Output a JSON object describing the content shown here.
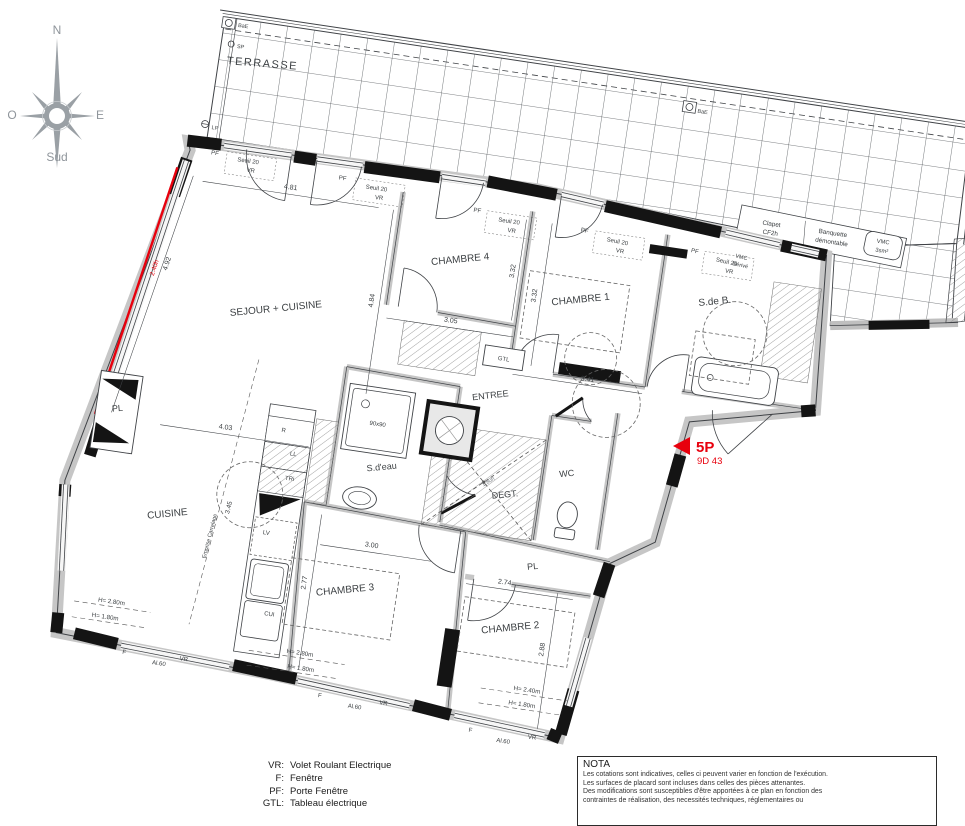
{
  "colors": {
    "red": "#e8000d",
    "line": "#3f4246",
    "wall_gray": "#c6c6c6",
    "text": "#3c4043",
    "compass": "#8f959b"
  },
  "compass": {
    "north": "N",
    "west": "O",
    "east": "E",
    "south": "Sud"
  },
  "marker": {
    "type_label": "5P",
    "ref": "9D 43"
  },
  "plan_labels": [
    {
      "n": "terrasse-label",
      "t": "TERRASSE",
      "x": 62,
      "y": 28,
      "r": -4,
      "s": 11,
      "ls": 1.5
    },
    {
      "n": "sejour-cuisine-label",
      "t": "SEJOUR + CUISINE",
      "x": 112,
      "y": 268,
      "r": -14,
      "s": 10
    },
    {
      "n": "chambre4-label",
      "t": "CHAMBRE 4",
      "x": 287,
      "y": 192,
      "r": -14,
      "s": 10
    },
    {
      "n": "chambre1-label",
      "t": "CHAMBRE 1",
      "x": 412,
      "y": 214,
      "r": -14,
      "s": 10
    },
    {
      "n": "salle-de-bain-label",
      "t": "S.de B.",
      "x": 545,
      "y": 196,
      "r": -14,
      "s": 10
    },
    {
      "n": "entree-label",
      "t": "ENTREE",
      "x": 337,
      "y": 322,
      "r": -15,
      "s": 9
    },
    {
      "n": "cuisine-label",
      "t": "CUISINE",
      "x": 35,
      "y": 487,
      "r": -14,
      "s": 10
    },
    {
      "n": "salle-eau-label",
      "t": "S.d'eau",
      "x": 240,
      "y": 409,
      "r": -14,
      "s": 9
    },
    {
      "n": "degagement-label",
      "t": "DEGT.",
      "x": 366,
      "y": 418,
      "r": -14,
      "s": 9
    },
    {
      "n": "wc-label",
      "t": "WC",
      "x": 424,
      "y": 388,
      "r": -14,
      "s": 9
    },
    {
      "n": "chambre3-label",
      "t": "CHAMBRE 3",
      "x": 222,
      "y": 536,
      "r": -14,
      "s": 10
    },
    {
      "n": "chambre2-label",
      "t": "CHAMBRE 2",
      "x": 391,
      "y": 549,
      "r": -14,
      "s": 10
    },
    {
      "n": "placard-west-label",
      "t": "PL",
      "x": -30,
      "y": 390,
      "r": -14,
      "s": 9
    },
    {
      "n": "placard-chambre2-label",
      "t": "PL",
      "x": 404,
      "y": 485,
      "r": -14,
      "s": 9
    },
    {
      "n": "dim-4-81",
      "t": "4.81",
      "x": 108,
      "y": 145
    },
    {
      "n": "dim-4-92",
      "t": "4.92",
      "x": -1,
      "y": 237,
      "r": -80
    },
    {
      "n": "dim-2-40h",
      "t": "2.40h",
      "x": -13,
      "y": 243,
      "r": -80,
      "s": 6.5,
      "c": "#e8000d"
    },
    {
      "n": "dim-4-84",
      "t": "4.84",
      "x": 207,
      "y": 243,
      "r": -90
    },
    {
      "n": "dim-3-05",
      "t": "3.05",
      "x": 286,
      "y": 253
    },
    {
      "n": "dim-3-32-a",
      "t": "3.32",
      "x": 342,
      "y": 193,
      "r": -90
    },
    {
      "n": "dim-3-32-b",
      "t": "3.32",
      "x": 367,
      "y": 214,
      "r": -90
    },
    {
      "n": "dim-3-41",
      "t": "3.41",
      "x": 430,
      "y": 291
    },
    {
      "n": "dim-4-03",
      "t": "4.03",
      "x": 79,
      "y": 392
    },
    {
      "n": "dim-3-45",
      "t": "3.45",
      "x": 96,
      "y": 469,
      "r": -84,
      "s": 6.5
    },
    {
      "n": "dim-3-00",
      "t": "3.00",
      "x": 241,
      "y": 487
    },
    {
      "n": "dim-2-77",
      "t": "2.77",
      "x": 182,
      "y": 532,
      "r": -90
    },
    {
      "n": "dim-2-74",
      "t": "2.74",
      "x": 378,
      "y": 504
    },
    {
      "n": "dim-2-88",
      "t": "2.88",
      "x": 427,
      "y": 563,
      "r": -90
    },
    {
      "n": "pf-label-1",
      "t": "PF",
      "x": 28,
      "y": 122,
      "s": 6
    },
    {
      "n": "seuil-label-1",
      "t": "Seuil 20",
      "x": 62,
      "y": 125,
      "s": 6
    },
    {
      "n": "vr-label-1",
      "t": "VR",
      "x": 66,
      "y": 134,
      "s": 6
    },
    {
      "n": "pf-label-2",
      "t": "PF",
      "x": 158,
      "y": 128,
      "s": 6
    },
    {
      "n": "seuil-label-2",
      "t": "Seuil 20",
      "x": 193,
      "y": 133,
      "s": 6
    },
    {
      "n": "vr-label-2",
      "t": "VR",
      "x": 197,
      "y": 142,
      "s": 6
    },
    {
      "n": "pf-label-3",
      "t": "PF",
      "x": 296,
      "y": 140,
      "s": 6
    },
    {
      "n": "seuil-label-3",
      "t": "Seuil 20",
      "x": 329,
      "y": 146,
      "s": 6
    },
    {
      "n": "vr-label-3",
      "t": "VR",
      "x": 333,
      "y": 155,
      "s": 6
    },
    {
      "n": "pf-label-4",
      "t": "PF",
      "x": 405,
      "y": 144,
      "r": 3,
      "s": 6
    },
    {
      "n": "seuil-label-4",
      "t": "Seuil 20",
      "x": 439,
      "y": 150,
      "r": 3,
      "s": 6
    },
    {
      "n": "vr-label-4",
      "t": "VR",
      "x": 443,
      "y": 159,
      "r": 3,
      "s": 6
    },
    {
      "n": "pf-label-5",
      "t": "PF",
      "x": 517,
      "y": 148,
      "r": 4,
      "s": 6
    },
    {
      "n": "seuil-label-5",
      "t": "Seuil 20",
      "x": 550,
      "y": 154,
      "r": 4,
      "s": 6
    },
    {
      "n": "vr-label-5",
      "t": "VR",
      "x": 554,
      "y": 163,
      "r": 4,
      "s": 6
    },
    {
      "n": "bae-label-left",
      "t": "BaE",
      "x": 32,
      "y": -8,
      "a": "start",
      "s": 5.5
    },
    {
      "n": "sp-label",
      "t": "SP",
      "x": 34,
      "y": 13,
      "a": "start",
      "s": 5.5
    },
    {
      "n": "lp-label",
      "t": "LP",
      "x": 21,
      "y": 97,
      "a": "start",
      "s": 5.5
    },
    {
      "n": "bae-label-right",
      "t": "BaE",
      "x": 499,
      "y": 9,
      "a": "start",
      "s": 5.5
    },
    {
      "n": "gtl-label",
      "t": "GTL",
      "x": 344,
      "y": 283,
      "s": 6
    },
    {
      "n": "shower-size-label",
      "t": "90x90",
      "x": 229,
      "y": 366,
      "s": 6
    },
    {
      "n": "emprise-carrelage-label",
      "t": "Emprise Carrelage",
      "x": 81,
      "y": 500,
      "r": -84,
      "s": 5.5
    },
    {
      "n": "clapet-label-1",
      "t": "Clapet",
      "x": 589,
      "y": 110,
      "s": 6.3
    },
    {
      "n": "clapet-label-2",
      "t": "CF2h",
      "x": 589,
      "y": 119,
      "s": 6.3
    },
    {
      "n": "banquette-label-1",
      "t": "Banquette",
      "x": 651,
      "y": 110,
      "s": 6.3
    },
    {
      "n": "banquette-label-2",
      "t": "démontable",
      "x": 651,
      "y": 119,
      "s": 6.3
    },
    {
      "n": "vmc-label-1",
      "t": "VMC",
      "x": 702,
      "y": 111,
      "s": 5.8
    },
    {
      "n": "vmc-label-2",
      "t": "3sm²",
      "x": 702,
      "y": 120,
      "s": 5.8
    },
    {
      "n": "vmc-derive-label-1",
      "t": "VMC",
      "x": 564,
      "y": 147,
      "r": 4,
      "s": 5.5
    },
    {
      "n": "vmc-derive-label-2",
      "t": "Dérivé",
      "x": 564,
      "y": 155,
      "r": 4,
      "s": 5.5
    },
    {
      "n": "refrigerateur-label",
      "t": "R",
      "x": 137,
      "y": 386,
      "s": 6
    },
    {
      "n": "lave-linge-label",
      "t": "LL",
      "x": 150,
      "y": 408,
      "s": 6
    },
    {
      "n": "tri-label",
      "t": "TRi",
      "x": 150,
      "y": 433,
      "s": 6
    },
    {
      "n": "lave-vaisselle-label",
      "t": "LV",
      "x": 135,
      "y": 490,
      "s": 6
    },
    {
      "n": "cuisiniere-label",
      "t": "CUI",
      "x": 150,
      "y": 570,
      "s": 6
    },
    {
      "n": "tremie-height-label",
      "t": "1.80h",
      "x": 348,
      "y": 406,
      "r": -40,
      "s": 5.5,
      "c": "#70757a"
    },
    {
      "n": "height-label-1a",
      "t": "H= 2.80m",
      "x": -8,
      "y": 581,
      "s": 6.2
    },
    {
      "n": "height-label-1b",
      "t": "H= 1.80m",
      "x": -12,
      "y": 597,
      "s": 6.2
    },
    {
      "n": "height-label-2a",
      "t": "H= 2.80m",
      "x": 186,
      "y": 604,
      "s": 6.2
    },
    {
      "n": "height-label-2b",
      "t": "H= 1.80m",
      "x": 189,
      "y": 619,
      "s": 6.2
    },
    {
      "n": "height-label-3a",
      "t": "H= 2.40m",
      "x": 416,
      "y": 607,
      "s": 6.2
    },
    {
      "n": "height-label-3b",
      "t": "H= 1.80m",
      "x": 413,
      "y": 622,
      "s": 6.2
    },
    {
      "n": "f-label-1",
      "t": "F",
      "x": 12,
      "y": 629,
      "s": 6
    },
    {
      "n": "allege-label-1",
      "t": "Al.60",
      "x": 48,
      "y": 635,
      "s": 6
    },
    {
      "n": "vr-window-label-1",
      "t": "VR",
      "x": 72,
      "y": 627,
      "s": 6
    },
    {
      "n": "f-label-2",
      "t": "F",
      "x": 212,
      "y": 643,
      "s": 6
    },
    {
      "n": "allege-label-2",
      "t": "Al.60",
      "x": 248,
      "y": 649,
      "s": 6
    },
    {
      "n": "vr-window-label-2",
      "t": "VR",
      "x": 276,
      "y": 641,
      "s": 6
    },
    {
      "n": "f-label-3",
      "t": "F",
      "x": 366,
      "y": 655,
      "s": 6
    },
    {
      "n": "allege-label-3",
      "t": "Al.60",
      "x": 400,
      "y": 661,
      "s": 6
    },
    {
      "n": "vr-window-label-3",
      "t": "VR",
      "x": 428,
      "y": 653,
      "s": 6
    }
  ],
  "screen_labels": [
    {
      "n": "lot-type-label",
      "t": "5P",
      "x": 696,
      "y": 452,
      "s": 15,
      "c": "#e8000d",
      "a": "start",
      "b": 1
    },
    {
      "n": "lot-ref-label",
      "t": "9D 43",
      "x": 697,
      "y": 464,
      "s": 9.5,
      "c": "#e8000d",
      "a": "start"
    },
    {
      "n": "compass-north-label",
      "t": "N",
      "x": 57,
      "y": 34,
      "s": 12,
      "c": "#8f959b"
    },
    {
      "n": "compass-west-label",
      "t": "O",
      "x": 12,
      "y": 119,
      "s": 12,
      "c": "#8f959b"
    },
    {
      "n": "compass-east-label",
      "t": "E",
      "x": 100,
      "y": 119,
      "s": 12,
      "c": "#8f959b"
    },
    {
      "n": "compass-south-label",
      "t": "Sud",
      "x": 57,
      "y": 161,
      "s": 12,
      "c": "#8f959b"
    }
  ],
  "legend": {
    "rows": [
      {
        "abbr": "VR:",
        "label": "Volet Roulant Electrique"
      },
      {
        "abbr": "F:",
        "label": "Fenêtre"
      },
      {
        "abbr": "PF:",
        "label": "Porte Fenêtre"
      },
      {
        "abbr": "GTL:",
        "label": "Tableau électrique"
      }
    ]
  },
  "nota": {
    "title": "NOTA",
    "lines": [
      "Les cotations sont indicatives, celles ci peuvent varier en fonction de l'exécution.",
      "Les surfaces de placard sont incluses dans celles des pièces attenantes.",
      "Des modifications sont susceptibles d'être apportées à ce plan en fonction des",
      "contraintes de réalisation, des necessités techniques, réglementaires ou"
    ]
  }
}
